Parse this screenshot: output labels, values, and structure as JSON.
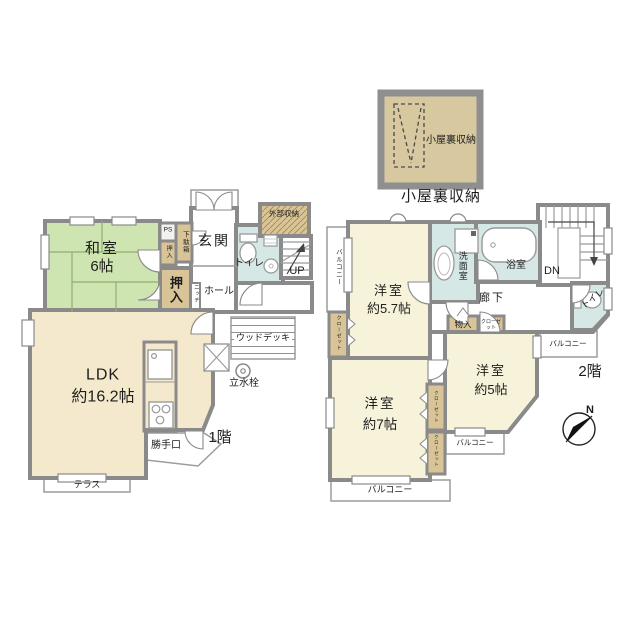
{
  "colors": {
    "wall": "#8a8a8a",
    "tatami_room": "#cfe5b1",
    "ldk_room": "#f5e9cd",
    "western_room": "#f6f3da",
    "storage": "#d8c497",
    "wet_area": "#d6e8e6",
    "attic": "#d7c8a0",
    "ps_box": "#f2f2ee"
  },
  "attic": {
    "label": "小屋裏収納",
    "caption": "小屋裏収納"
  },
  "f1": {
    "floor_tag": "1階",
    "washitsu_name": "和室",
    "washitsu_size": "6帖",
    "oshiire": "押入",
    "oshiire_small": "押入",
    "getabako": "下駄箱",
    "ps": "PS",
    "genkan": "玄関",
    "toilet": "トイレ",
    "niche": "ニッチ",
    "hall": "ホール",
    "gaibu_shuno": "外部収納",
    "up": "UP",
    "ldk_name": "LDK",
    "ldk_size": "約16.2帖",
    "katteguchi": "勝手口",
    "wood_deck": "ウッドデッキ",
    "rissuisen": "立水栓",
    "terrace": "テラス"
  },
  "f2": {
    "floor_tag": "2階",
    "yoshitsu57_name": "洋室",
    "yoshitsu57_size": "約5.7帖",
    "yoshitsu7_name": "洋室",
    "yoshitsu7_size": "約7帖",
    "yoshitsu5_name": "洋室",
    "yoshitsu5_size": "約5帖",
    "senmenshitsu": "洗面室",
    "yokushitsu": "浴室",
    "rouka": "廊下",
    "dn": "DN",
    "toilet": "トイレ",
    "monoire": "物入",
    "closet": "クローゼット",
    "balcony": "バルコニー",
    "compass_n": "N"
  }
}
